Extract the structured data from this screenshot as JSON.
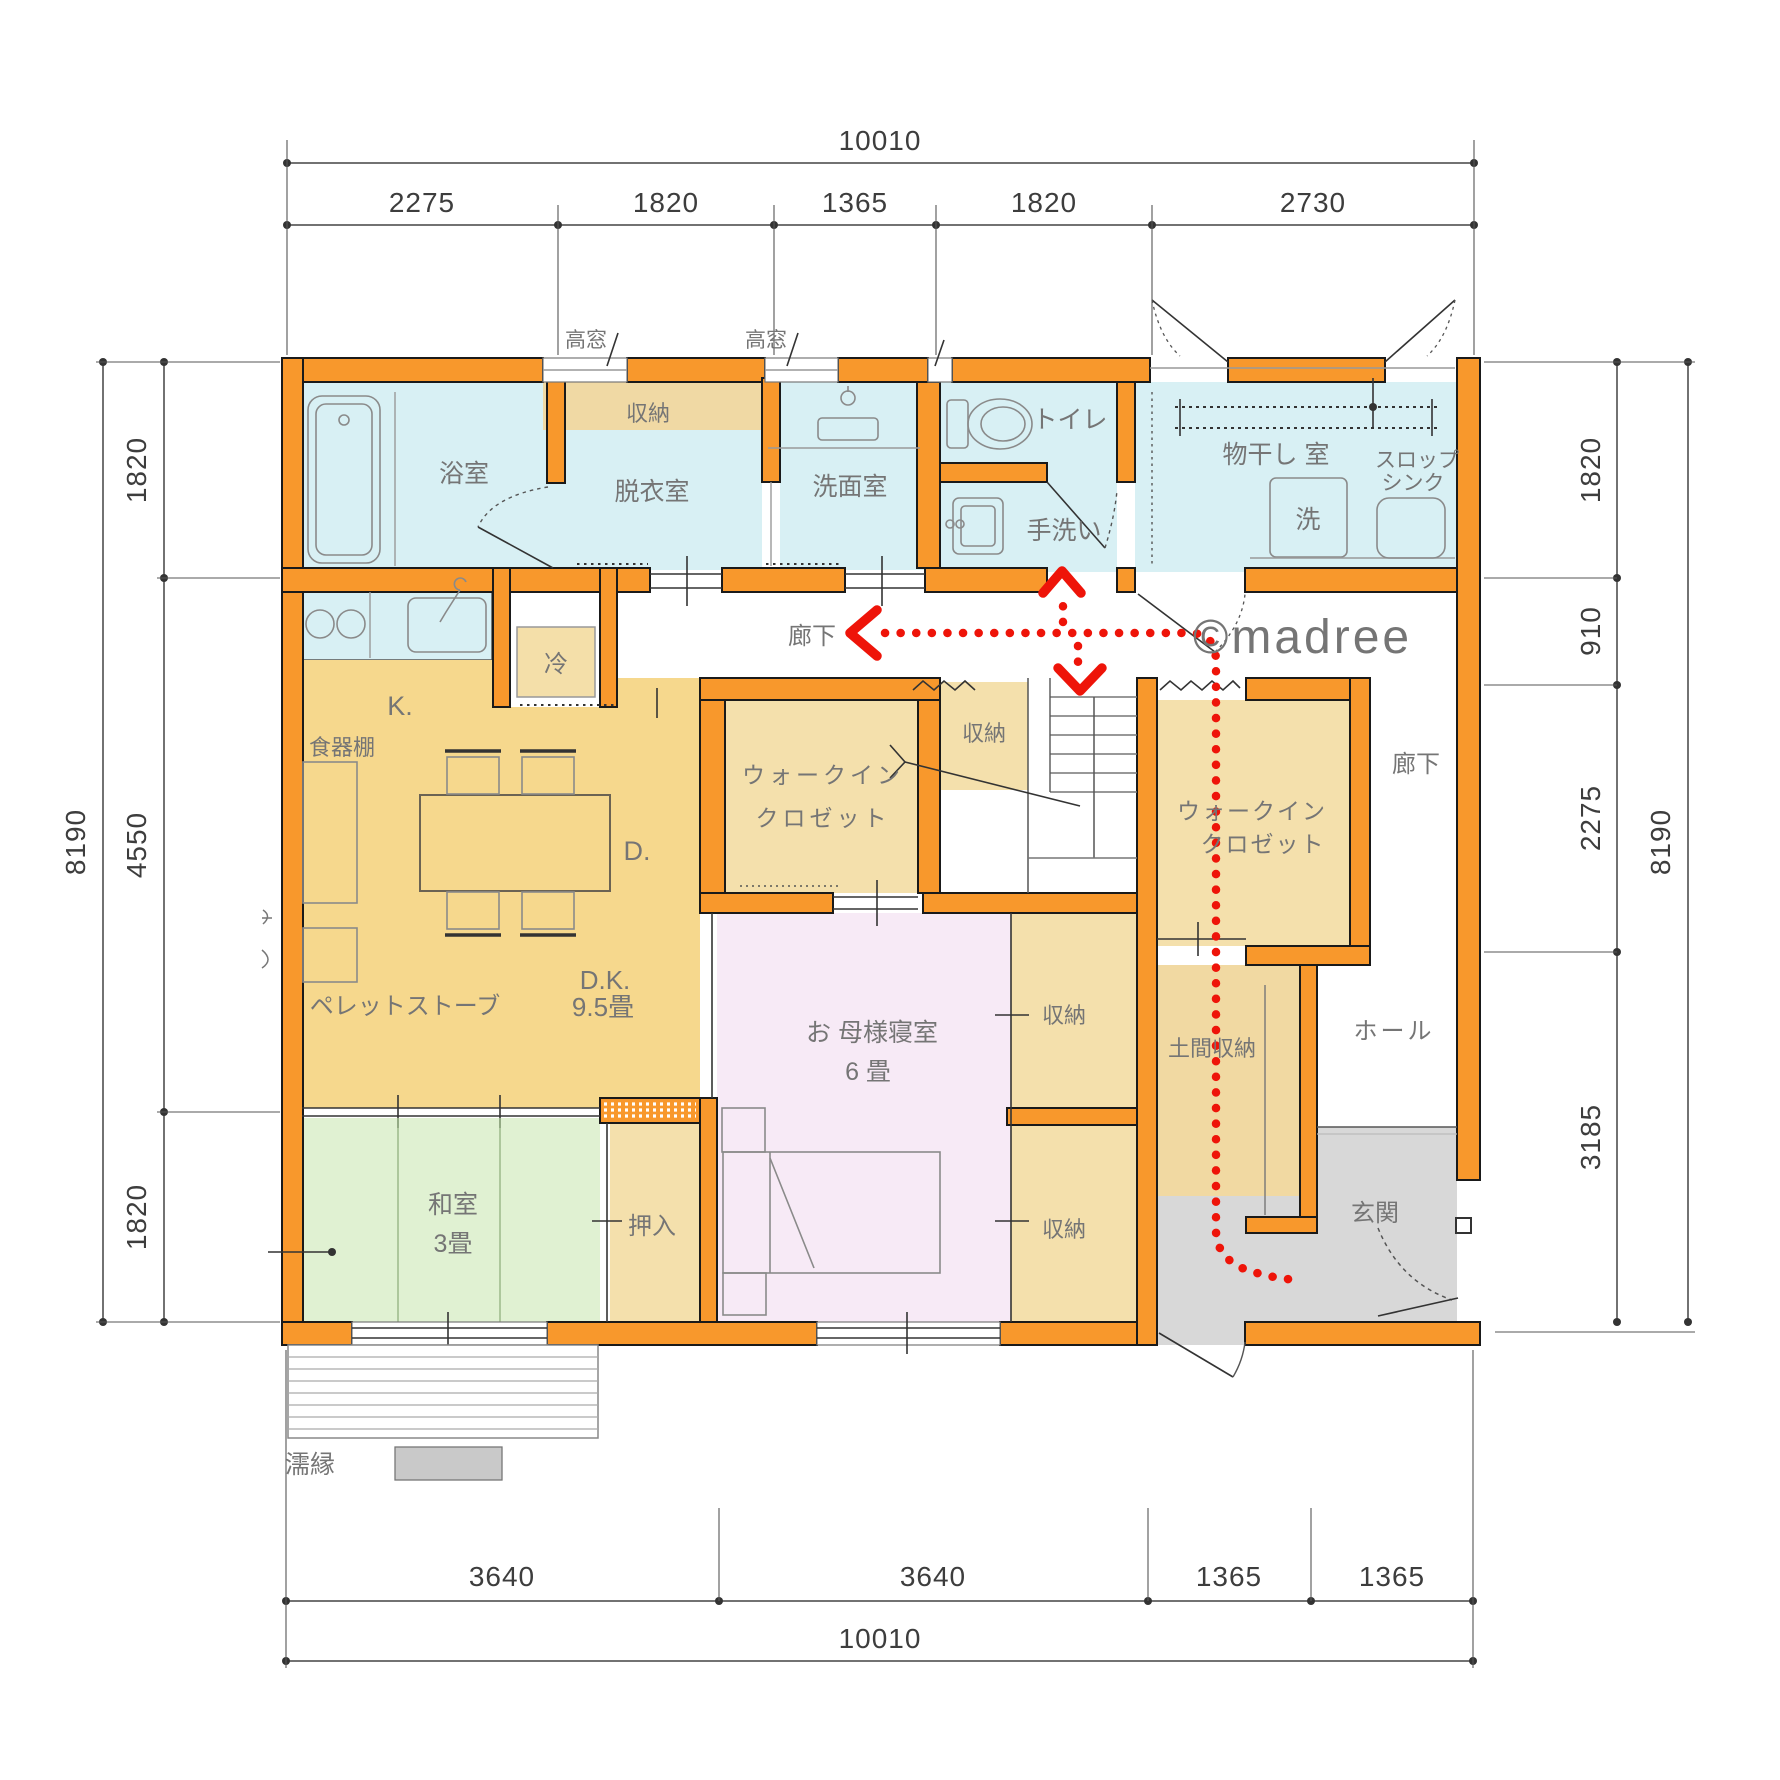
{
  "watermark": "©madree",
  "labels": {
    "bath": "浴室",
    "dressing": "脱衣室",
    "dressing_storage": "収納",
    "highwin1": "高窓",
    "highwin2": "高窓",
    "washroom": "洗面室",
    "toilet": "トイレ",
    "handwash": "手洗い",
    "drying": "物干し 室",
    "washer": "洗",
    "slop1": "スロップ",
    "slop2": "シンク",
    "kitchen": "K.",
    "fridge": "冷",
    "cupboard": "食器棚",
    "dining": "D.",
    "pellet_stove": "ペレットストーブ",
    "dk": "D.K.",
    "dk_size": "9.5畳",
    "corridor": "廊下",
    "corridor_right": "廊下",
    "wic1a": "ウォークイン",
    "wic1b": "クロゼット",
    "wic2a": "ウォークイン",
    "wic2b": "クロゼット",
    "storage_stair": "収納",
    "storage_bed1": "収納",
    "storage_bed2": "収納",
    "bedroom": "お 母様寝室",
    "bedroom_size": "6 畳",
    "doma": "土間収納",
    "hall": "ホール",
    "genkan": "玄関",
    "washitsu": "和室",
    "washitsu_size": "3畳",
    "oshiire": "押入",
    "engawa": "濡縁"
  },
  "dims": {
    "top_total": "10010",
    "top": [
      "2275",
      "1820",
      "1365",
      "1820",
      "2730"
    ],
    "bottom": [
      "3640",
      "3640",
      "1365",
      "1365"
    ],
    "bottom_total": "10010",
    "left_total": "8190",
    "left": [
      "1820",
      "4550",
      "1820"
    ],
    "right_total": "8190",
    "right": [
      "1820",
      "910",
      "2275",
      "3185"
    ]
  },
  "colors": {
    "wall_orange": "#f8982c",
    "wet_cyan": "#d8f0f4",
    "storage_tan": "#f4e0ac",
    "dk_tan": "#f6d88d",
    "bedroom_pink": "#f7eaf6",
    "tatami_green": "#e0f1d2",
    "genkan_gray": "#d8d8d8",
    "route_red": "#ee1409",
    "watermark_gray": "#cbcbcb"
  }
}
